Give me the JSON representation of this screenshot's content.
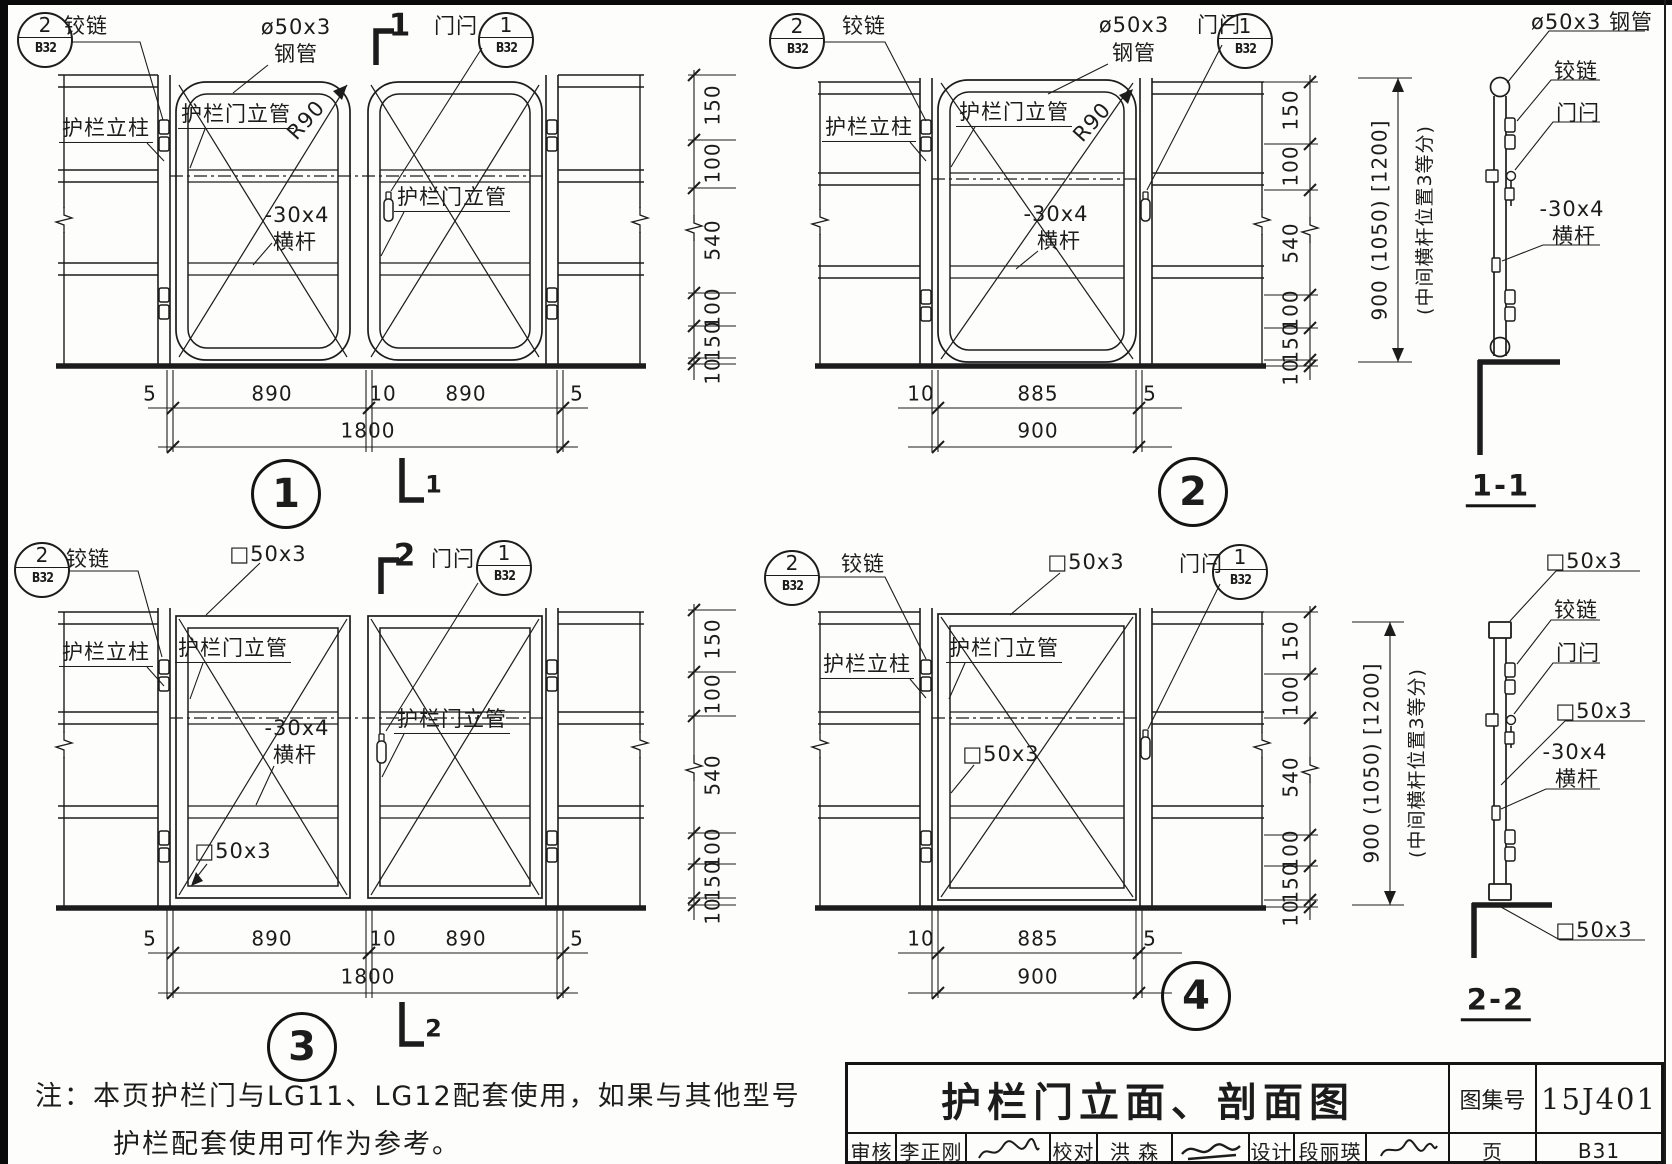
{
  "sheet": {
    "title": "护栏门立面、剖面图",
    "atlas_label": "图集号",
    "atlas_no": "15J401",
    "page_label": "页",
    "page_no": "B31",
    "review_label": "审核",
    "review_name": "李正刚",
    "proof_label": "校对",
    "proof_name": "洪  森",
    "design_label": "设计",
    "design_name": "段丽瑛"
  },
  "note": {
    "line1": "注：本页护栏门与LG11、LG12配套使用，如果与其他型号",
    "line2": "护栏配套使用可作为参考。"
  },
  "refs": [
    {
      "num": "2",
      "page": "B32",
      "x": 45,
      "y": 40
    },
    {
      "num": "1",
      "page": "B32",
      "x": 506,
      "y": 40
    },
    {
      "num": "2",
      "page": "B32",
      "x": 797,
      "y": 41
    },
    {
      "num": "1",
      "page": "B32",
      "x": 1245,
      "y": 41
    },
    {
      "num": "2",
      "page": "B32",
      "x": 42,
      "y": 570
    },
    {
      "num": "1",
      "page": "B32",
      "x": 504,
      "y": 568
    },
    {
      "num": "2",
      "page": "B32",
      "x": 792,
      "y": 578
    },
    {
      "num": "1",
      "page": "B32",
      "x": 1240,
      "y": 572
    }
  ],
  "plates": [
    {
      "num": "1",
      "x": 286,
      "y": 494
    },
    {
      "num": "2",
      "x": 1193,
      "y": 492
    },
    {
      "num": "3",
      "x": 302,
      "y": 1047
    },
    {
      "num": "4",
      "x": 1196,
      "y": 996
    }
  ],
  "labels": [
    {
      "n": "d1-hinge-label",
      "t": "铰链",
      "x": 86,
      "y": 26,
      "fs": 21
    },
    {
      "n": "d1-pipe-spec",
      "t": "ø50x3",
      "x": 296,
      "y": 27,
      "fs": 21
    },
    {
      "n": "d1-pipe-spec2",
      "t": "钢管",
      "x": 296,
      "y": 54,
      "fs": 21
    },
    {
      "n": "d1-latch-label",
      "t": "门闩",
      "x": 456,
      "y": 26,
      "fs": 21
    },
    {
      "n": "d1-post-label",
      "t": "护栏立柱",
      "x": 106,
      "y": 130,
      "fs": 21,
      "k": "tu"
    },
    {
      "n": "d1-doorpipe-label",
      "t": "护栏门立管",
      "x": 236,
      "y": 116,
      "fs": 21,
      "k": "tu"
    },
    {
      "n": "d1-radius-label",
      "t": "R90",
      "x": 306,
      "y": 120,
      "fs": 21,
      "k": "d"
    },
    {
      "n": "d1-bar-spec",
      "t": "-30x4",
      "x": 297,
      "y": 215,
      "fs": 21
    },
    {
      "n": "d1-bar-label",
      "t": "横杆",
      "x": 295,
      "y": 242,
      "fs": 21
    },
    {
      "n": "d1-doorpipe2-label",
      "t": "护栏门立管",
      "x": 452,
      "y": 199,
      "fs": 21,
      "k": "tu"
    },
    {
      "n": "d1-cut-number-top",
      "t": "1",
      "x": 400,
      "y": 26,
      "fs": 31,
      "k": "b"
    },
    {
      "n": "d1-cut-number-bottom",
      "t": "1",
      "x": 434,
      "y": 485,
      "fs": 24,
      "k": "b"
    },
    {
      "n": "d1-vdim-150a",
      "t": "150",
      "x": 713,
      "y": 105,
      "fs": 20,
      "k": "v"
    },
    {
      "n": "d1-vdim-100a",
      "t": "100",
      "x": 713,
      "y": 163,
      "fs": 20,
      "k": "v"
    },
    {
      "n": "d1-vdim-540",
      "t": "540",
      "x": 713,
      "y": 240,
      "fs": 20,
      "k": "v"
    },
    {
      "n": "d1-vdim-100b",
      "t": "100",
      "x": 713,
      "y": 308,
      "fs": 20,
      "k": "v"
    },
    {
      "n": "d1-vdim-150b",
      "t": "150",
      "x": 713,
      "y": 341,
      "fs": 20,
      "k": "v"
    },
    {
      "n": "d1-vdim-10",
      "t": "10",
      "x": 713,
      "y": 371,
      "fs": 20,
      "k": "v"
    },
    {
      "n": "d1-hdim-5a",
      "t": "5",
      "x": 150,
      "y": 394,
      "fs": 20
    },
    {
      "n": "d1-hdim-890a",
      "t": "890",
      "x": 272,
      "y": 394,
      "fs": 20
    },
    {
      "n": "d1-hdim-10",
      "t": "10",
      "x": 383,
      "y": 394,
      "fs": 20
    },
    {
      "n": "d1-hdim-890b",
      "t": "890",
      "x": 466,
      "y": 394,
      "fs": 20
    },
    {
      "n": "d1-hdim-5b",
      "t": "5",
      "x": 577,
      "y": 394,
      "fs": 20
    },
    {
      "n": "d1-hdim-1800",
      "t": "1800",
      "x": 368,
      "y": 431,
      "fs": 20
    },
    {
      "n": "d2-hinge-label",
      "t": "铰链",
      "x": 864,
      "y": 26,
      "fs": 21
    },
    {
      "n": "d2-pipe-spec",
      "t": "ø50x3",
      "x": 1134,
      "y": 25,
      "fs": 21
    },
    {
      "n": "d2-pipe-spec2",
      "t": "钢管",
      "x": 1134,
      "y": 53,
      "fs": 21
    },
    {
      "n": "d2-latch-label",
      "t": "门闩",
      "x": 1219,
      "y": 25,
      "fs": 21
    },
    {
      "n": "d2-post-label",
      "t": "护栏立柱",
      "x": 869,
      "y": 129,
      "fs": 21,
      "k": "tu"
    },
    {
      "n": "d2-doorpipe-label",
      "t": "护栏门立管",
      "x": 1014,
      "y": 114,
      "fs": 21,
      "k": "tu"
    },
    {
      "n": "d2-radius-label",
      "t": "R90",
      "x": 1092,
      "y": 122,
      "fs": 21,
      "k": "d"
    },
    {
      "n": "d2-bar-spec",
      "t": "-30x4",
      "x": 1056,
      "y": 214,
      "fs": 21
    },
    {
      "n": "d2-bar-label",
      "t": "横杆",
      "x": 1059,
      "y": 241,
      "fs": 21
    },
    {
      "n": "d2-vdim-150a",
      "t": "150",
      "x": 1291,
      "y": 110,
      "fs": 20,
      "k": "v"
    },
    {
      "n": "d2-vdim-100a",
      "t": "100",
      "x": 1291,
      "y": 166,
      "fs": 20,
      "k": "v"
    },
    {
      "n": "d2-vdim-540",
      "t": "540",
      "x": 1291,
      "y": 243,
      "fs": 20,
      "k": "v"
    },
    {
      "n": "d2-vdim-100b",
      "t": "100",
      "x": 1291,
      "y": 310,
      "fs": 20,
      "k": "v"
    },
    {
      "n": "d2-vdim-150b",
      "t": "150",
      "x": 1291,
      "y": 343,
      "fs": 20,
      "k": "v"
    },
    {
      "n": "d2-vdim-10",
      "t": "10",
      "x": 1291,
      "y": 372,
      "fs": 20,
      "k": "v"
    },
    {
      "n": "d2-hdim-10",
      "t": "10",
      "x": 921,
      "y": 394,
      "fs": 20
    },
    {
      "n": "d2-hdim-885",
      "t": "885",
      "x": 1038,
      "y": 394,
      "fs": 20
    },
    {
      "n": "d2-hdim-5",
      "t": "5",
      "x": 1150,
      "y": 394,
      "fs": 20
    },
    {
      "n": "d2-hdim-900",
      "t": "900",
      "x": 1038,
      "y": 431,
      "fs": 20
    },
    {
      "n": "s11-pipe-spec",
      "t": "ø50x3 钢管",
      "x": 1592,
      "y": 22,
      "fs": 21
    },
    {
      "n": "s11-hinge-label",
      "t": "铰链",
      "x": 1576,
      "y": 71,
      "fs": 21
    },
    {
      "n": "s11-latch-label",
      "t": "门闩",
      "x": 1578,
      "y": 113,
      "fs": 21
    },
    {
      "n": "s11-bar-spec",
      "t": "-30x4",
      "x": 1572,
      "y": 209,
      "fs": 21
    },
    {
      "n": "s11-bar-label",
      "t": "横杆",
      "x": 1574,
      "y": 236,
      "fs": 21
    },
    {
      "n": "s11-height-dim",
      "t": "900 (1050) [1200]",
      "x": 1380,
      "y": 220,
      "fs": 20,
      "k": "v"
    },
    {
      "n": "s11-midbar-note",
      "t": "(中间横杆位置3等分)",
      "x": 1426,
      "y": 220,
      "fs": 19,
      "k": "v"
    },
    {
      "n": "s11-title",
      "t": "1-1",
      "x": 1501,
      "y": 489,
      "fs": 29,
      "k": "ti"
    },
    {
      "n": "d3-hinge-label",
      "t": "铰链",
      "x": 88,
      "y": 559,
      "fs": 21
    },
    {
      "n": "d3-tube-spec",
      "t": "□50x3",
      "x": 268,
      "y": 554,
      "fs": 21
    },
    {
      "n": "d3-latch-label",
      "t": "门闩",
      "x": 453,
      "y": 559,
      "fs": 21
    },
    {
      "n": "d3-post-label",
      "t": "护栏立柱",
      "x": 106,
      "y": 654,
      "fs": 21,
      "k": "tu"
    },
    {
      "n": "d3-doorpipe-label",
      "t": "护栏门立管",
      "x": 233,
      "y": 650,
      "fs": 21,
      "k": "tu"
    },
    {
      "n": "d3-bar-spec",
      "t": "-30x4",
      "x": 297,
      "y": 728,
      "fs": 21
    },
    {
      "n": "d3-bar-label",
      "t": "横杆",
      "x": 295,
      "y": 755,
      "fs": 21
    },
    {
      "n": "d3-doorpipe2-label",
      "t": "护栏门立管",
      "x": 452,
      "y": 721,
      "fs": 21,
      "k": "tu"
    },
    {
      "n": "d3-tube-spec2",
      "t": "□50x3",
      "x": 233,
      "y": 851,
      "fs": 21
    },
    {
      "n": "d3-cut-number-top",
      "t": "2",
      "x": 405,
      "y": 556,
      "fs": 31,
      "k": "b"
    },
    {
      "n": "d3-cut-number-bottom",
      "t": "2",
      "x": 434,
      "y": 1029,
      "fs": 24,
      "k": "b"
    },
    {
      "n": "d3-vdim-150a",
      "t": "150",
      "x": 713,
      "y": 639,
      "fs": 20,
      "k": "v"
    },
    {
      "n": "d3-vdim-100a",
      "t": "100",
      "x": 713,
      "y": 694,
      "fs": 20,
      "k": "v"
    },
    {
      "n": "d3-vdim-540",
      "t": "540",
      "x": 713,
      "y": 775,
      "fs": 20,
      "k": "v"
    },
    {
      "n": "d3-vdim-100b",
      "t": "100",
      "x": 713,
      "y": 848,
      "fs": 20,
      "k": "v"
    },
    {
      "n": "d3-vdim-150b",
      "t": "150",
      "x": 713,
      "y": 881,
      "fs": 20,
      "k": "v"
    },
    {
      "n": "d3-vdim-10",
      "t": "10",
      "x": 713,
      "y": 911,
      "fs": 20,
      "k": "v"
    },
    {
      "n": "d3-hdim-5a",
      "t": "5",
      "x": 150,
      "y": 939,
      "fs": 20
    },
    {
      "n": "d3-hdim-890a",
      "t": "890",
      "x": 272,
      "y": 939,
      "fs": 20
    },
    {
      "n": "d3-hdim-10",
      "t": "10",
      "x": 383,
      "y": 939,
      "fs": 20
    },
    {
      "n": "d3-hdim-890b",
      "t": "890",
      "x": 466,
      "y": 939,
      "fs": 20
    },
    {
      "n": "d3-hdim-5b",
      "t": "5",
      "x": 577,
      "y": 939,
      "fs": 20
    },
    {
      "n": "d3-hdim-1800",
      "t": "1800",
      "x": 368,
      "y": 977,
      "fs": 20
    },
    {
      "n": "d4-hinge-label",
      "t": "铰链",
      "x": 863,
      "y": 564,
      "fs": 21
    },
    {
      "n": "d4-tube-spec",
      "t": "□50x3",
      "x": 1086,
      "y": 562,
      "fs": 21
    },
    {
      "n": "d4-latch-label",
      "t": "门闩",
      "x": 1201,
      "y": 564,
      "fs": 21
    },
    {
      "n": "d4-post-label",
      "t": "护栏立柱",
      "x": 867,
      "y": 666,
      "fs": 21,
      "k": "tu"
    },
    {
      "n": "d4-doorpipe-label",
      "t": "护栏门立管",
      "x": 1004,
      "y": 650,
      "fs": 21,
      "k": "tu"
    },
    {
      "n": "d4-tube-spec2",
      "t": "□50x3",
      "x": 1001,
      "y": 754,
      "fs": 21
    },
    {
      "n": "d4-vdim-150a",
      "t": "150",
      "x": 1291,
      "y": 641,
      "fs": 20,
      "k": "v"
    },
    {
      "n": "d4-vdim-100a",
      "t": "100",
      "x": 1291,
      "y": 696,
      "fs": 20,
      "k": "v"
    },
    {
      "n": "d4-vdim-540",
      "t": "540",
      "x": 1291,
      "y": 777,
      "fs": 20,
      "k": "v"
    },
    {
      "n": "d4-vdim-100b",
      "t": "100",
      "x": 1291,
      "y": 850,
      "fs": 20,
      "k": "v"
    },
    {
      "n": "d4-vdim-150b",
      "t": "150",
      "x": 1291,
      "y": 883,
      "fs": 20,
      "k": "v"
    },
    {
      "n": "d4-vdim-10",
      "t": "10",
      "x": 1291,
      "y": 913,
      "fs": 20,
      "k": "v"
    },
    {
      "n": "d4-hdim-10",
      "t": "10",
      "x": 921,
      "y": 939,
      "fs": 20
    },
    {
      "n": "d4-hdim-885",
      "t": "885",
      "x": 1038,
      "y": 939,
      "fs": 20
    },
    {
      "n": "d4-hdim-5",
      "t": "5",
      "x": 1150,
      "y": 939,
      "fs": 20
    },
    {
      "n": "d4-hdim-900",
      "t": "900",
      "x": 1038,
      "y": 977,
      "fs": 20
    },
    {
      "n": "s22-tube-spec-top",
      "t": "□50x3",
      "x": 1584,
      "y": 561,
      "fs": 21
    },
    {
      "n": "s22-hinge-label",
      "t": "铰链",
      "x": 1576,
      "y": 610,
      "fs": 21
    },
    {
      "n": "s22-latch-label",
      "t": "门闩",
      "x": 1578,
      "y": 653,
      "fs": 21
    },
    {
      "n": "s22-tube-spec-mid",
      "t": "□50x3",
      "x": 1594,
      "y": 711,
      "fs": 21
    },
    {
      "n": "s22-bar-spec",
      "t": "-30x4",
      "x": 1575,
      "y": 752,
      "fs": 21
    },
    {
      "n": "s22-bar-label",
      "t": "横杆",
      "x": 1577,
      "y": 779,
      "fs": 21
    },
    {
      "n": "s22-tube-spec-bot",
      "t": "□50x3",
      "x": 1594,
      "y": 930,
      "fs": 21
    },
    {
      "n": "s22-height-dim",
      "t": "900 (1050) [1200]",
      "x": 1372,
      "y": 763,
      "fs": 20,
      "k": "v"
    },
    {
      "n": "s22-midbar-note",
      "t": "(中间横杆位置3等分)",
      "x": 1418,
      "y": 763,
      "fs": 19,
      "k": "v"
    },
    {
      "n": "s22-title",
      "t": "2-2",
      "x": 1496,
      "y": 1003,
      "fs": 29,
      "k": "ti"
    }
  ]
}
